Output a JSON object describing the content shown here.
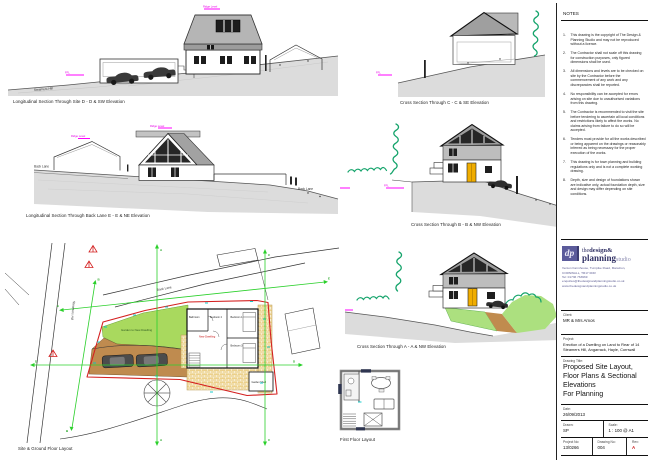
{
  "drawings": {
    "long_section_site": {
      "caption": "Longitudinal Section Through Site D - D & SW Elevation",
      "road_label": "Steamers Hill"
    },
    "cross_section_c": {
      "caption": "Cross Section Through C - C & SE Elevation"
    },
    "long_section_back_lane": {
      "caption": "Longitudinal Section Through Back Lane E - E & NE Elevation",
      "road_label_left": "Back Lane",
      "road_label_right": "Back Lane"
    },
    "cross_section_b": {
      "caption": "Cross Section Through B - B & NW Elevation"
    },
    "cross_section_a": {
      "caption": "Cross Section Through A - A & NW Elevation"
    },
    "first_floor": {
      "caption": "First Floor Layout"
    },
    "site_plan": {
      "caption": "Site & Ground Floor Layout",
      "back_lane_label": "Back Lane",
      "steamers_hill_label": "Steamers Hill",
      "garden_label": "Garden to New Dwelling",
      "new_dwelling_label": "New Dwelling",
      "shed_label": "Garden Shed",
      "rooms": {
        "bathroom": "Bathroom",
        "bedroom1": "Bedroom 1",
        "bedroom2": "Bedroom 2",
        "bedroom3": "Bedroom 3"
      },
      "section_letters": {
        "a": "A",
        "b": "B",
        "c": "C",
        "d": "D",
        "e": "E"
      }
    },
    "annotations": {
      "ridge": "Ridge Level",
      "ffl": "FFL"
    }
  },
  "notes": {
    "title": "NOTES",
    "items": [
      {
        "n": "1.",
        "text": "This drawing is the copyright of The Design & Planning Studio and may not be reproduced without a licence."
      },
      {
        "n": "2.",
        "text": "The Contractor shall not scale off this drawing for construction purposes, only figured dimensions shall be used."
      },
      {
        "n": "3.",
        "text": "All dimensions and levels are to be checked on site by the Contractor before the commencement of any work and any discrepancies shall be reported."
      },
      {
        "n": "4.",
        "text": "No responsibility can be accepted for errors arising on site due to unauthorised variations from this drawing."
      },
      {
        "n": "5.",
        "text": "The Contractor is recommended to visit the site before tendering to ascertain all local conditions and restrictions likely to affect the works. No claims arising from failure to do so will be accepted."
      },
      {
        "n": "6.",
        "text": "Tenders must provide for all the works described or being apparent on the drawings or reasonably inferred as being necessary for the proper execution of the works."
      },
      {
        "n": "7.",
        "text": "This drawing is for town planning and building regulations only and is not a complete working drawing."
      },
      {
        "n": "8.",
        "text": "Depth, size and design of foundations shown are indicative only, actual foundation depth, size and design may differ depending on site conditions."
      }
    ]
  },
  "title_block": {
    "logo": {
      "initials": "dp",
      "name_the": "the",
      "name_design": "design&",
      "name_planning": "planning",
      "name_studio": "studio"
    },
    "address_lines": [
      "Venton Farmhouse, Turnpike Road, Marazion,",
      "CORNWALL, TR17 0DR",
      "Tel: 01736 763969",
      "enquiries@thedesignandplanningstudio.co.uk",
      "www.thedesignandplanningstudio.co.uk"
    ],
    "client_label": "Client:",
    "client": "MR & Mrs Amos",
    "project_label": "Project:",
    "project": "Erection of a Dwelling on Land to Rear of 14 Steamers Hill, Angarrack, Hayle, Cornwall",
    "drawing_title_label": "Drawing Title:",
    "drawing_title_lines": [
      "Proposed Site Layout,",
      "Floor Plans & Sectional",
      "Elevations",
      "For Planning"
    ],
    "date_label": "Date:",
    "date": "26/09/2013",
    "drawn_label": "Drawn:",
    "drawn": "SP",
    "scale_label": "Scale:",
    "scale": "1 : 100 @ A1",
    "project_no_label": "Project No:",
    "project_no": "13/0266",
    "drawing_no_label": "Drawing No:",
    "drawing_no": "004",
    "rev_label": "Rev:",
    "rev": "A"
  },
  "colors": {
    "boundary_red": "#d42020",
    "section_green": "#2bd02b",
    "hedge_green": "#16a46c",
    "garden_green": "#a9d95e",
    "grass_green": "#ace07f",
    "drive_tan": "#bf8b4f",
    "patio_tan": "#ecd08a",
    "door_yellow": "#f0ad00",
    "annotation_magenta": "#ff00ff",
    "ground_grey": "#dcdcdc",
    "logo_purple": "#5b5b9b",
    "rev_red": "#cc2222"
  }
}
